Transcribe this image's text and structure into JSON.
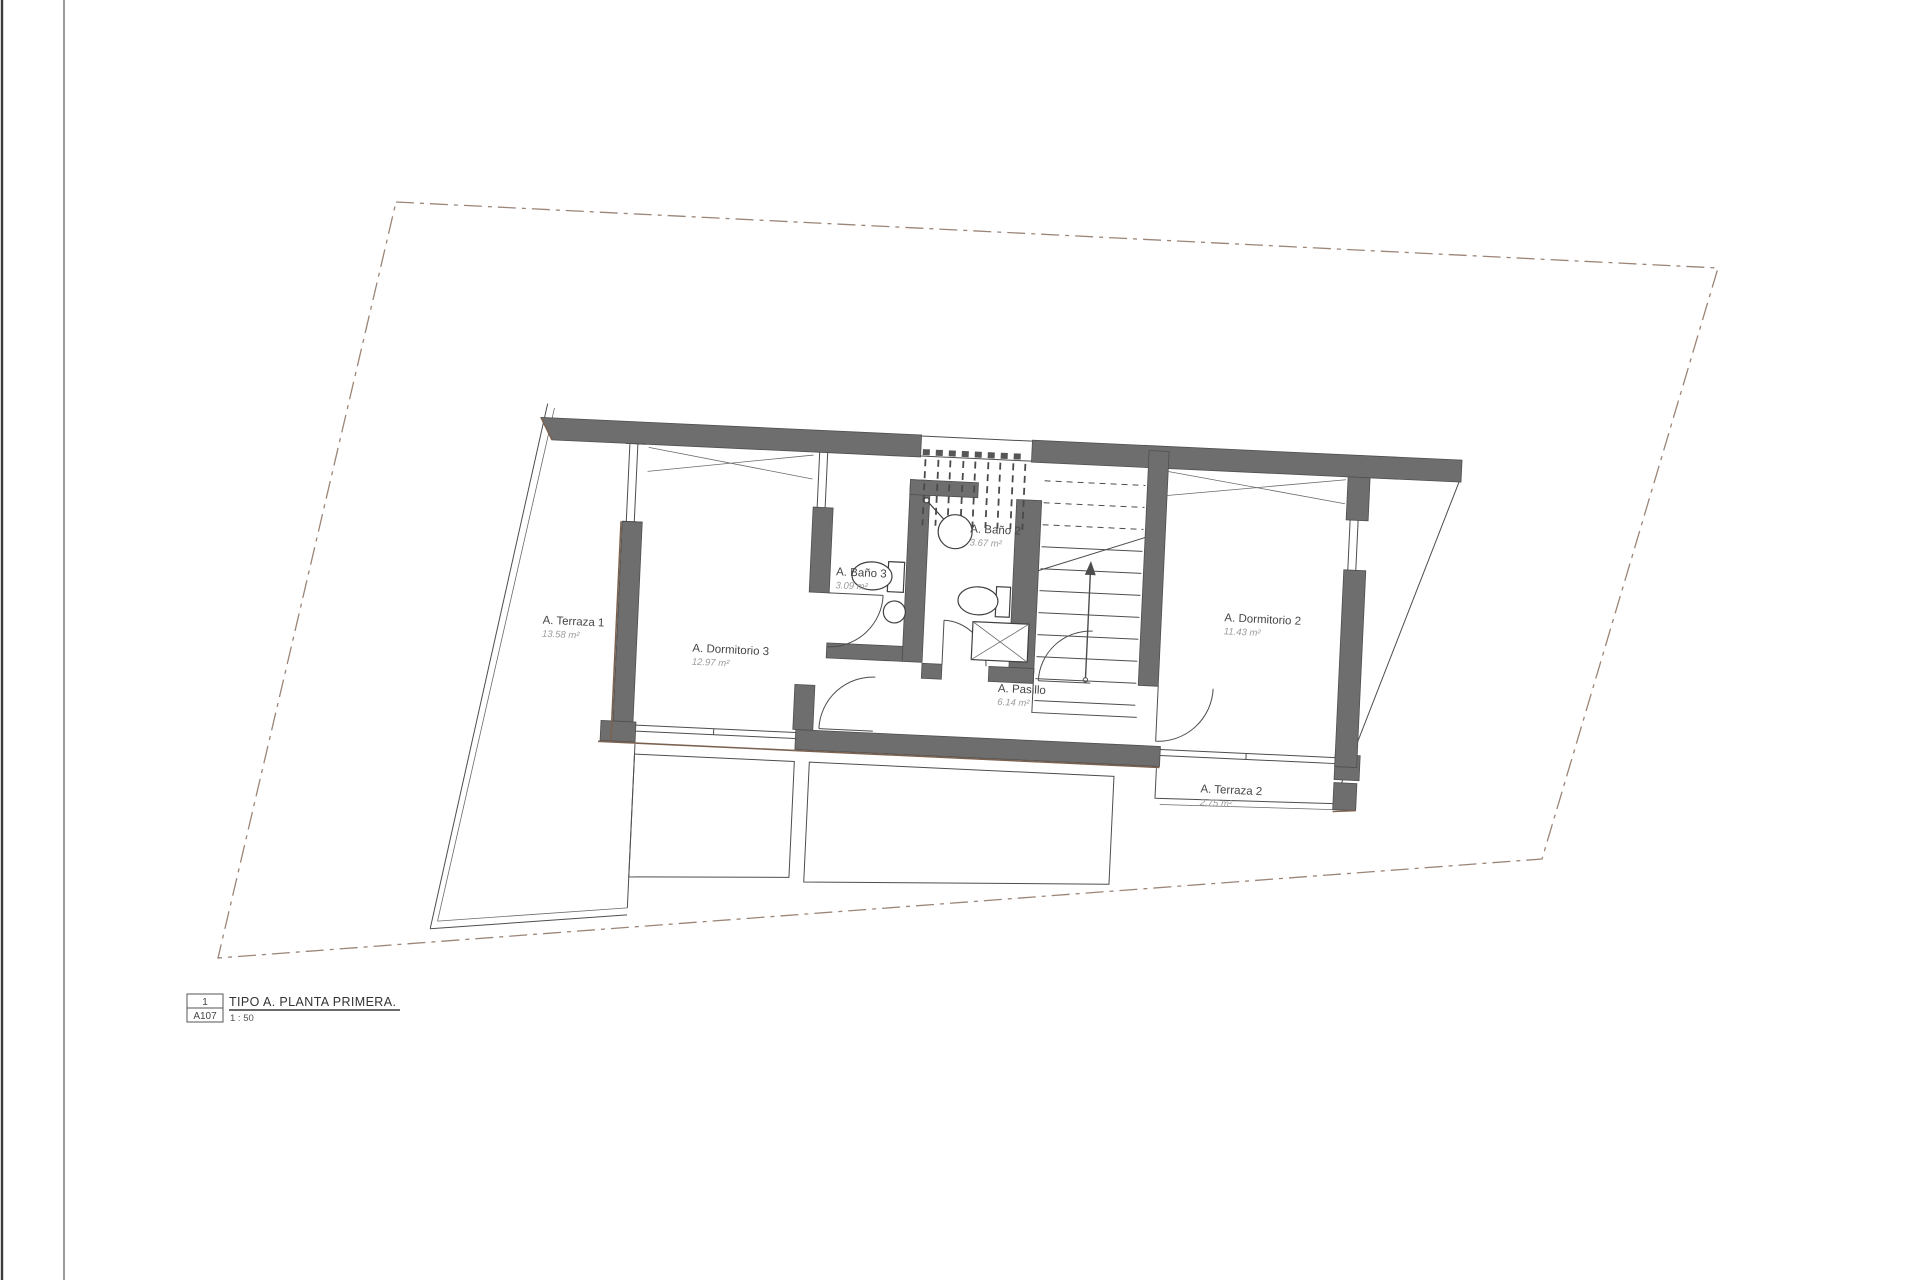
{
  "drawing": {
    "rooms": [
      {
        "name": "A. Terraza 1",
        "area": "13.58 m²"
      },
      {
        "name": "A. Dormitorio 3",
        "area": "12.97 m²"
      },
      {
        "name": "A. Baño 3",
        "area": "3.09 m²"
      },
      {
        "name": "A. Baño 2",
        "area": "3.67 m²"
      },
      {
        "name": "A. Pasillo",
        "area": "6.14 m²"
      },
      {
        "name": "A. Dormitorio 2",
        "area": "11.43 m²"
      },
      {
        "name": "A. Terraza 2",
        "area": "2.75 m²"
      }
    ],
    "title_block": {
      "detail_number": "1",
      "sheet_number": "A107",
      "title": "TIPO A. PLANTA PRIMERA.",
      "scale": "1 : 50"
    },
    "colors": {
      "wall_fill": "#6e6e6e",
      "wall_edge": "#4f4f4f",
      "line": "#4d4d4d",
      "boundary": "#9b8577",
      "accent_brown": "#7b6250",
      "label_text": "#454545",
      "area_text": "#9b9b9b"
    }
  }
}
